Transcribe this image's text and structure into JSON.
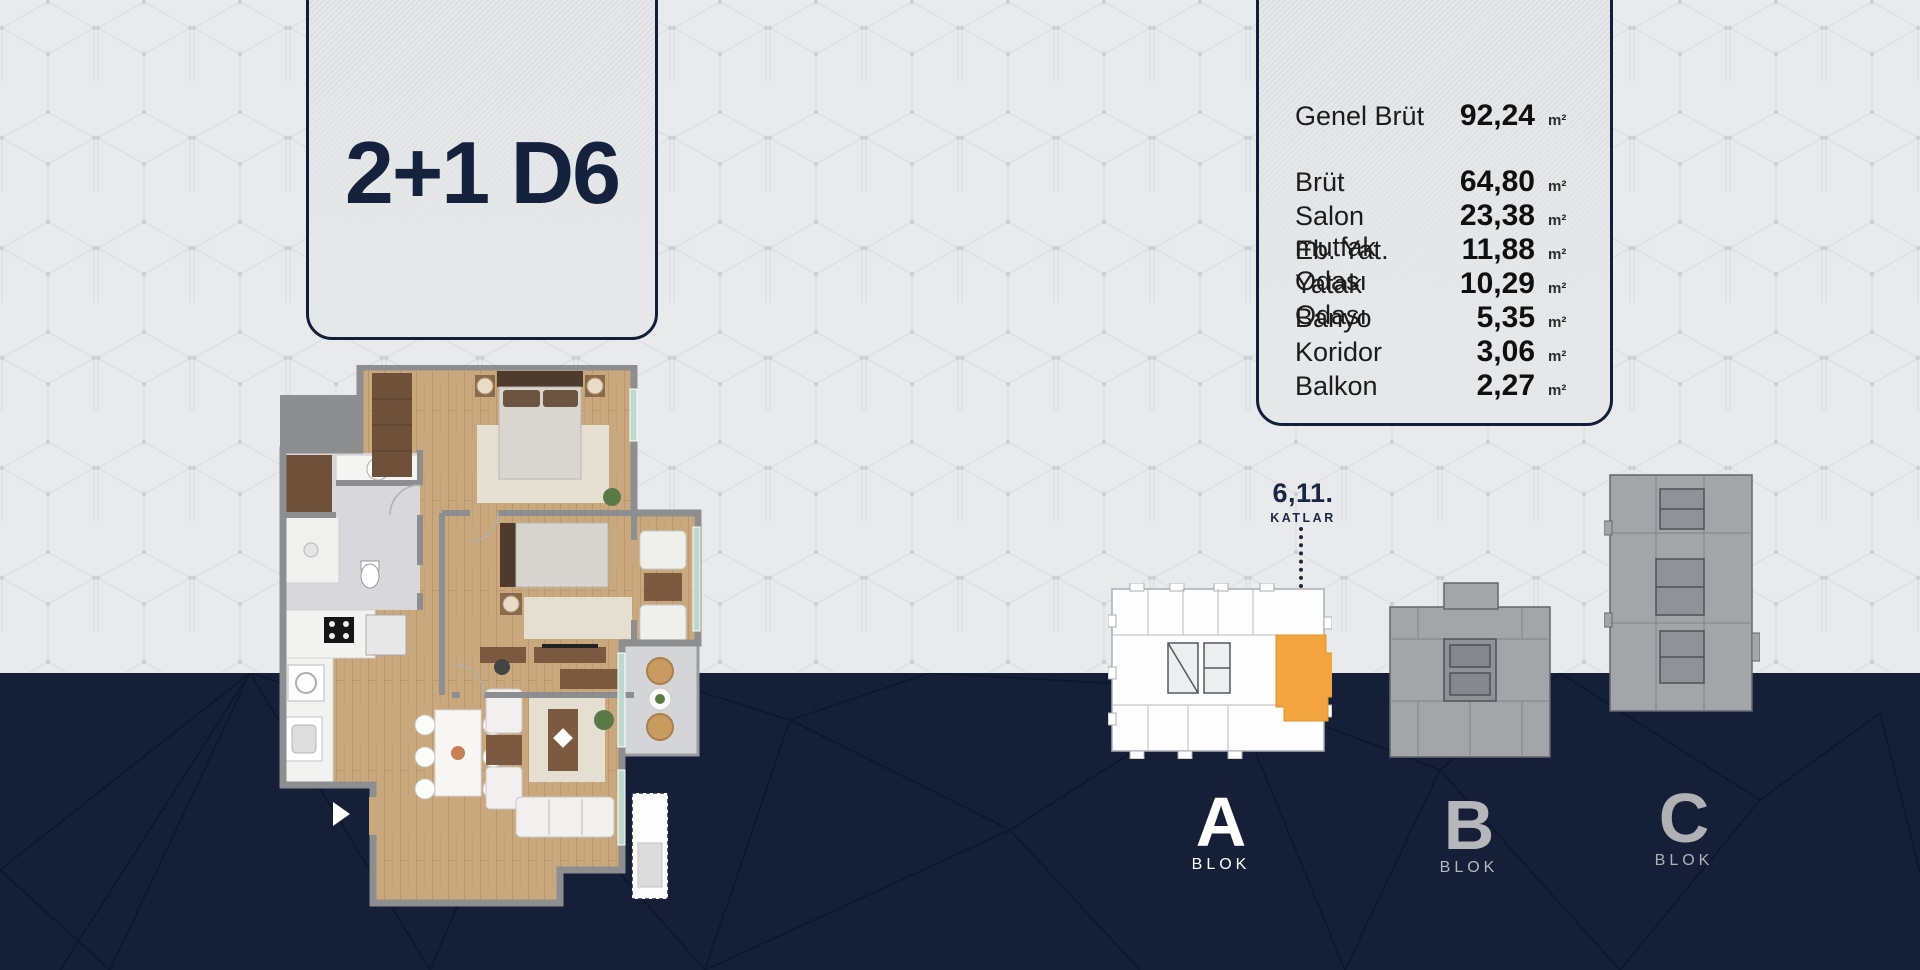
{
  "unit_card": {
    "title": "2+1 D6"
  },
  "area_card": {
    "rows": [
      {
        "label": "Genel Brüt",
        "value": "92,24",
        "unit": "m²"
      },
      {
        "label": "Brüt",
        "value": "64,80",
        "unit": "m²"
      },
      {
        "label": "Salon mutfak",
        "value": "23,38",
        "unit": "m²"
      },
      {
        "label": "Eb. Yat. Odası",
        "value": "11,88",
        "unit": "m²"
      },
      {
        "label": "Yatak Odası",
        "value": "10,29",
        "unit": "m²"
      },
      {
        "label": "Banyo",
        "value": "5,35",
        "unit": "m²"
      },
      {
        "label": "Koridor",
        "value": "3,06",
        "unit": "m²"
      },
      {
        "label": "Balkon",
        "value": "2,27",
        "unit": "m²"
      }
    ]
  },
  "floor_indicator": {
    "floors": "6,11.",
    "label": "KATLAR"
  },
  "blocks": [
    {
      "letter": "A",
      "label": "BLOK",
      "active": true
    },
    {
      "letter": "B",
      "label": "BLOK",
      "active": false
    },
    {
      "letter": "C",
      "label": "BLOK",
      "active": false
    }
  ],
  "colors": {
    "highlight_unit": "#F2A43E",
    "navy_background": "#151F38",
    "light_background": "#E9EAEC",
    "card_border": "#111F3B"
  }
}
